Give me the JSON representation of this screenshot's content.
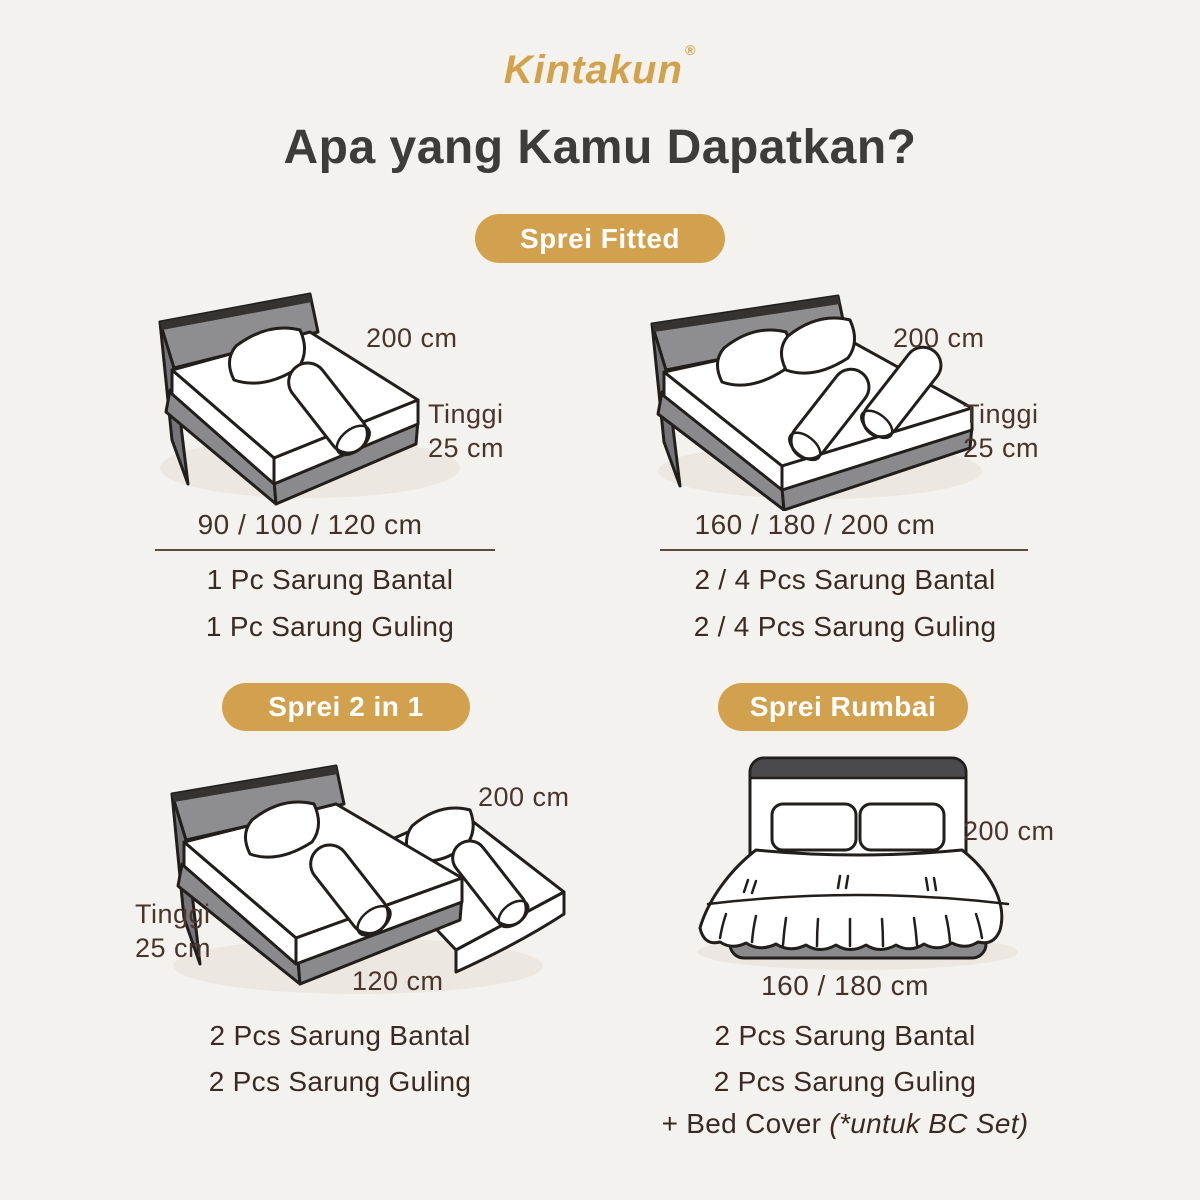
{
  "colors": {
    "background": "#F4F2EE",
    "gold_accent": "#D1A14D",
    "title_text": "#3E3C3A",
    "label_text": "#4A342B",
    "item_text": "#3B2A23",
    "illustration_gray": "#8E8E90",
    "illustration_outline": "#211E1C"
  },
  "header": {
    "logo": "Kintakun",
    "registered_mark": "®",
    "title": "Apa yang Kamu Dapatkan?"
  },
  "sections": {
    "fitted": {
      "badge": "Sprei Fitted",
      "single": {
        "width_label": "200 cm",
        "height_label": {
          "line1": "Tinggi",
          "line2": "25 cm"
        },
        "sizes": "90 / 100 / 120 cm",
        "items": [
          "1 Pc Sarung Bantal",
          "1 Pc Sarung Guling"
        ]
      },
      "double": {
        "width_label": "200 cm",
        "height_label": {
          "line1": "Tinggi",
          "line2": "25 cm"
        },
        "sizes": "160 / 180 / 200 cm",
        "items": [
          "2 / 4 Pcs Sarung Bantal",
          "2 / 4 Pcs Sarung Guling"
        ]
      }
    },
    "two_in_one": {
      "badge": "Sprei 2 in 1",
      "width_label": "200 cm",
      "height_label": {
        "line1": "Tinggi",
        "line2": "25 cm"
      },
      "bottom_label": "120 cm",
      "items": [
        "2 Pcs Sarung Bantal",
        "2 Pcs Sarung Guling"
      ]
    },
    "rumbai": {
      "badge": "Sprei Rumbai",
      "width_label": "200 cm",
      "bottom_label": "160 / 180 cm",
      "items": [
        "2 Pcs Sarung Bantal",
        "2 Pcs Sarung Guling"
      ],
      "extra_item": {
        "prefix": "+ Bed Cover ",
        "italic": "(*untuk BC Set)"
      }
    }
  }
}
